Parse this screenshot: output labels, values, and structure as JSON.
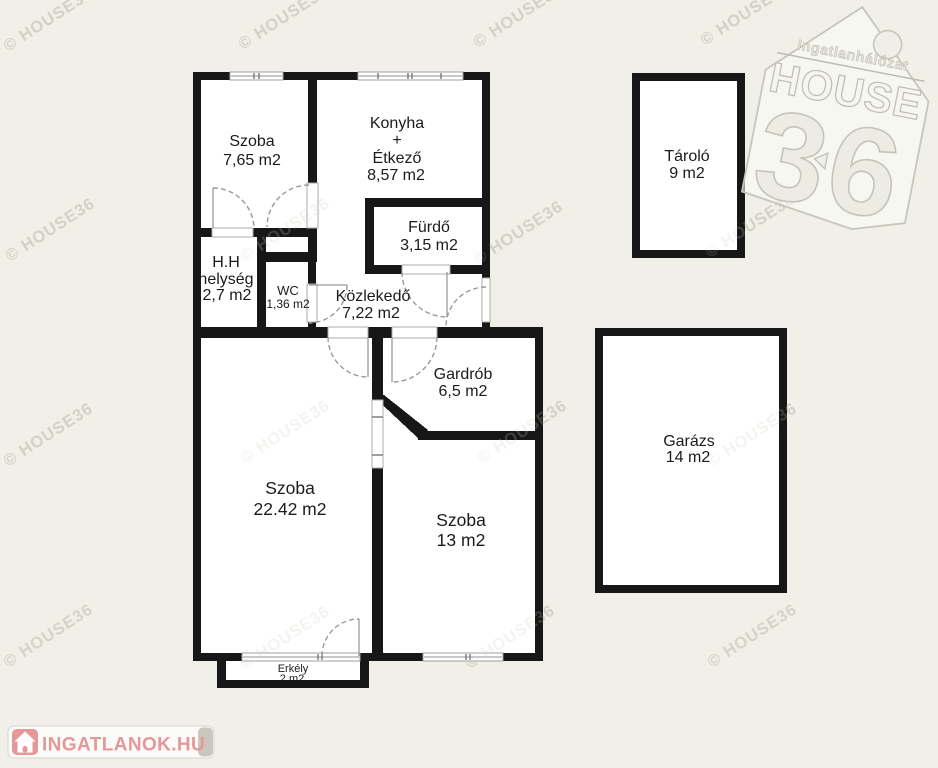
{
  "watermark": {
    "text": "© HOUSE36"
  },
  "brand_logo": {
    "network": "Ingatlanhálózat",
    "name": "HOUSE",
    "number": "36"
  },
  "footer_logo": {
    "text": "INGATLANOK.HU"
  },
  "rooms": {
    "szoba1": {
      "name": "Szoba",
      "area": "7,65 m2"
    },
    "konyha": {
      "name1": "Konyha",
      "name2": "+",
      "name3": "Étkező",
      "area": "8,57 m2"
    },
    "furdo": {
      "name": "Fürdő",
      "area": "3,15 m2"
    },
    "hh": {
      "name1": "H.H",
      "name2": "helység",
      "area": "2,7 m2"
    },
    "wc": {
      "name": "WC",
      "area": "1,36 m2"
    },
    "kozlekedo": {
      "name": "Közlekedő",
      "area": "7,22 m2"
    },
    "gardrob": {
      "name": "Gardrób",
      "area": "6,5 m2"
    },
    "szoba_nagy": {
      "name": "Szoba",
      "area": "22.42 m2"
    },
    "szoba_kis": {
      "name": "Szoba",
      "area": "13 m2"
    },
    "erkely": {
      "name": "Erkély",
      "area": "2 m2"
    },
    "tarolo": {
      "name": "Tároló",
      "area": "9 m2"
    },
    "garazs": {
      "name": "Garázs",
      "area": "14 m2"
    }
  },
  "colors": {
    "background": "#f0efe8",
    "wall": "#171717",
    "room": "#ffffff",
    "watermark": "#d6d4c8",
    "logo_pink": "#e59898"
  }
}
